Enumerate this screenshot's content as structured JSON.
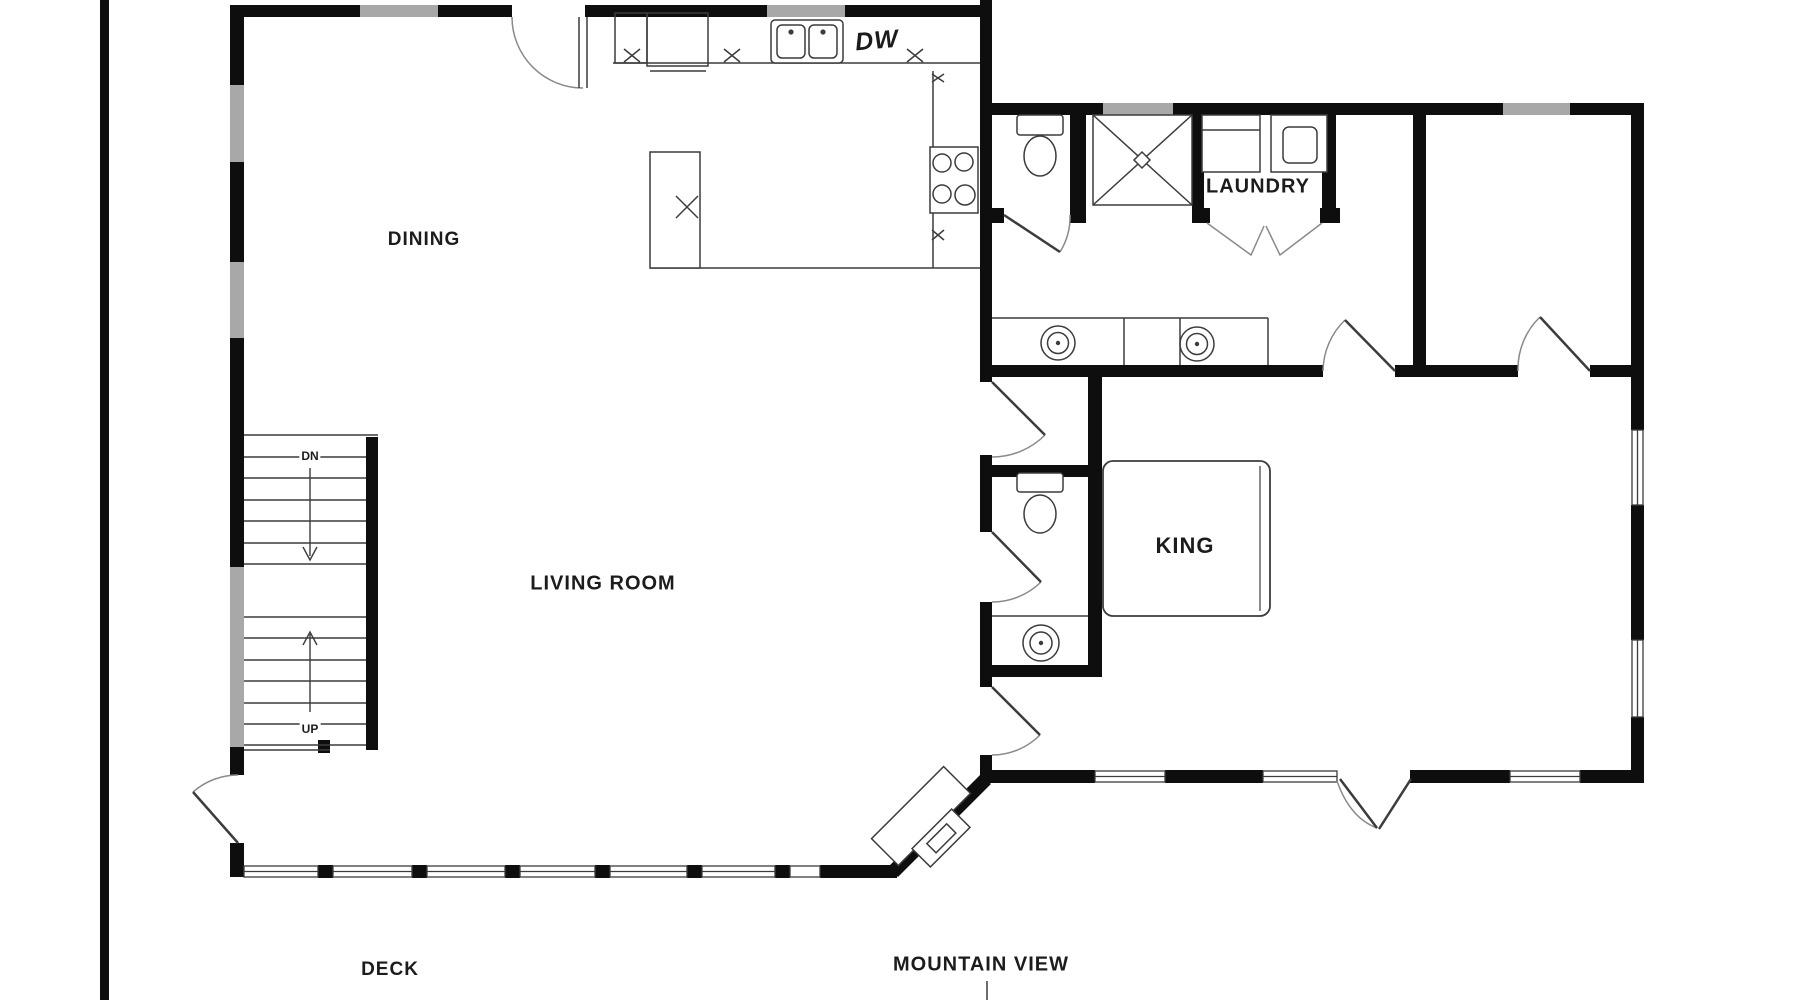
{
  "labels": {
    "dining": "DINING",
    "living_room": "LIVING ROOM",
    "king": "KING",
    "laundry": "LAUNDRY",
    "deck": "DECK",
    "mountain_view": "MOUNTAIN VIEW",
    "dishwasher": "DW",
    "stair_down": "DN",
    "stair_up": "UP"
  },
  "colors": {
    "wall": "#0e0e0e",
    "window_glass": "#a8a8a8",
    "line": "#3c3c3c",
    "door_arc": "#8a8a8a",
    "background": "#ffffff"
  },
  "fixtures": [
    "staircase",
    "fireplace",
    "kitchen-island",
    "kitchen-double-sink",
    "range-cooktop",
    "pantry-cabinets",
    "dishwasher",
    "washer",
    "dryer",
    "shower",
    "toilet-master-bath",
    "toilet-powder-room",
    "double-vanity-sinks",
    "powder-room-sink",
    "king-bed",
    "entry-door",
    "deck-door",
    "french-doors",
    "bifold-doors"
  ]
}
